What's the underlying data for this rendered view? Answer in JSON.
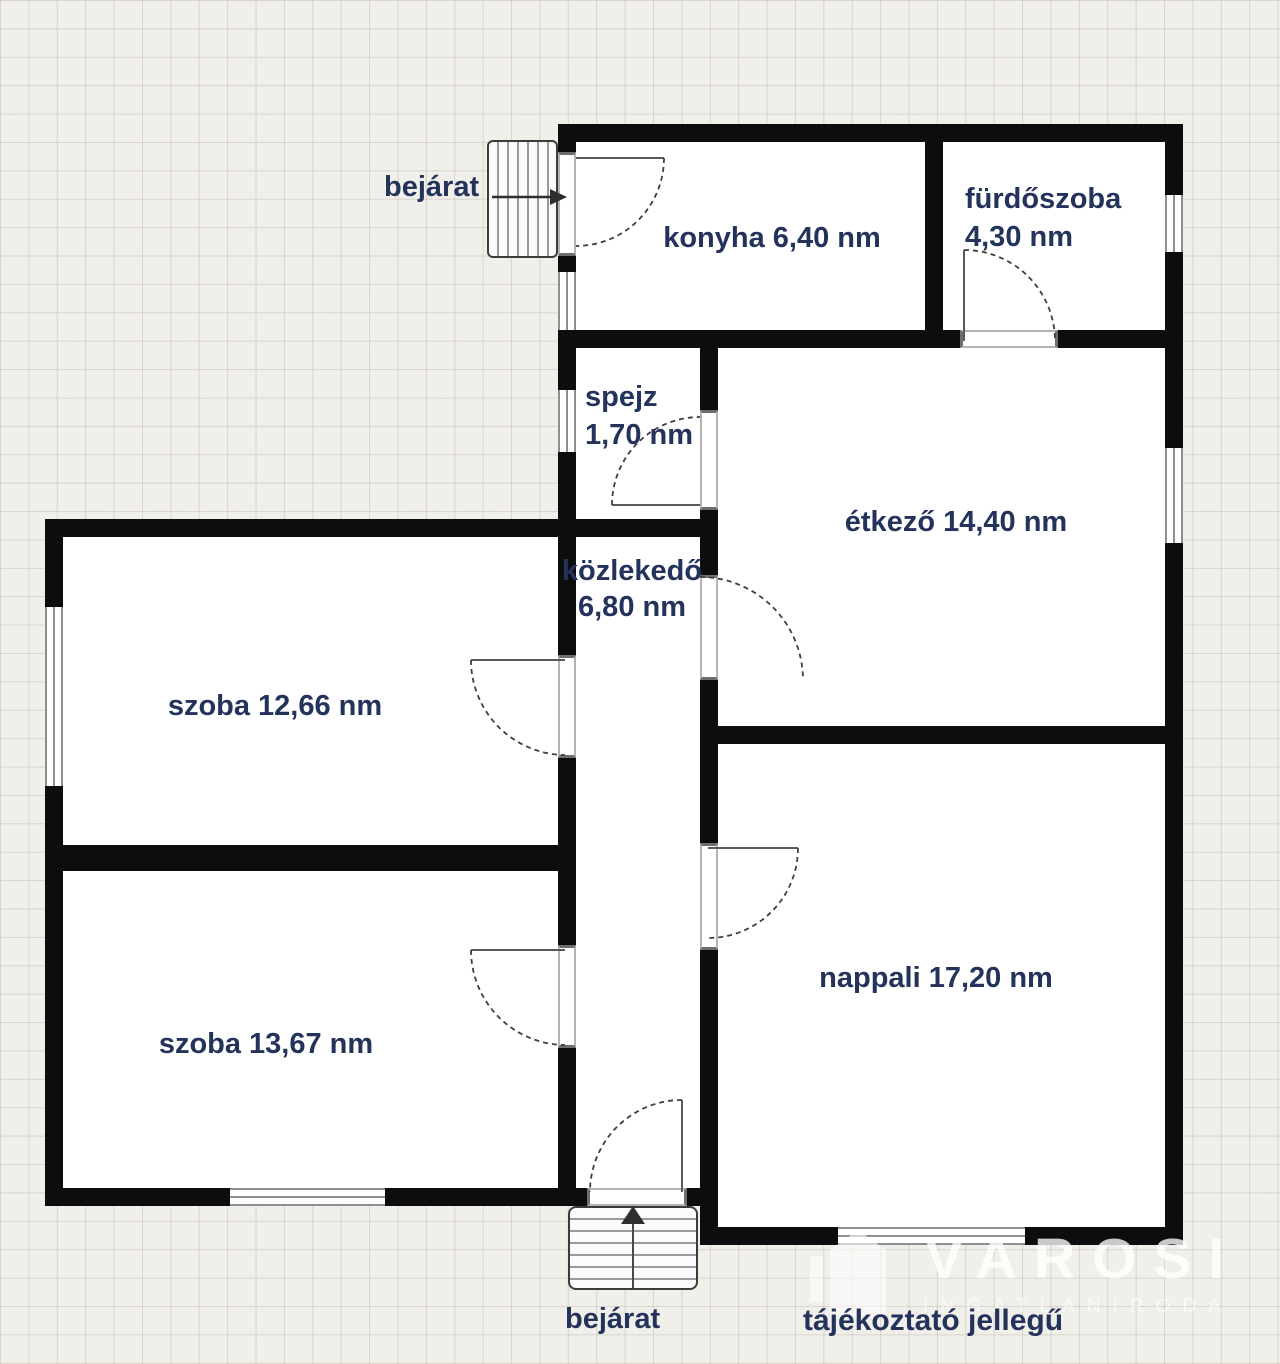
{
  "plan_type": "floor-plan",
  "rooms": {
    "konyha": {
      "name": "konyha",
      "area": "6,40 nm",
      "label": "konyha 6,40 nm"
    },
    "furdoszoba": {
      "name": "fürdőszoba",
      "area": "4,30 nm"
    },
    "spejz": {
      "name": "spejz",
      "area": "1,70 nm"
    },
    "etkezo": {
      "name": "étkező",
      "area": "14,40 nm",
      "label": "étkező 14,40 nm"
    },
    "kozlekedo": {
      "name": "közlekedő",
      "area": "6,80 nm"
    },
    "szoba1": {
      "name": "szoba",
      "area": "12,66 nm",
      "label": "szoba 12,66 nm"
    },
    "szoba2": {
      "name": "szoba",
      "area": "13,67 nm",
      "label": "szoba 13,67 nm"
    },
    "nappali": {
      "name": "nappali",
      "area": "17,20 nm",
      "label": "nappali 17,20 nm"
    }
  },
  "entrances": {
    "top": "bejárat",
    "bottom": "bejárat"
  },
  "watermark": {
    "brand": "VAROSI",
    "subtitle": "INGATLANIRODA"
  },
  "disclaimer": "tájékoztató jellegű",
  "colors": {
    "wall": "#0d0d0d",
    "label_text": "#24335b",
    "background": "#f0efea",
    "grid_line": "#d9d6cd",
    "room_floor": "#ffffff",
    "watermark_text": "#ffffff",
    "window_frame": "#8f8f8f"
  }
}
